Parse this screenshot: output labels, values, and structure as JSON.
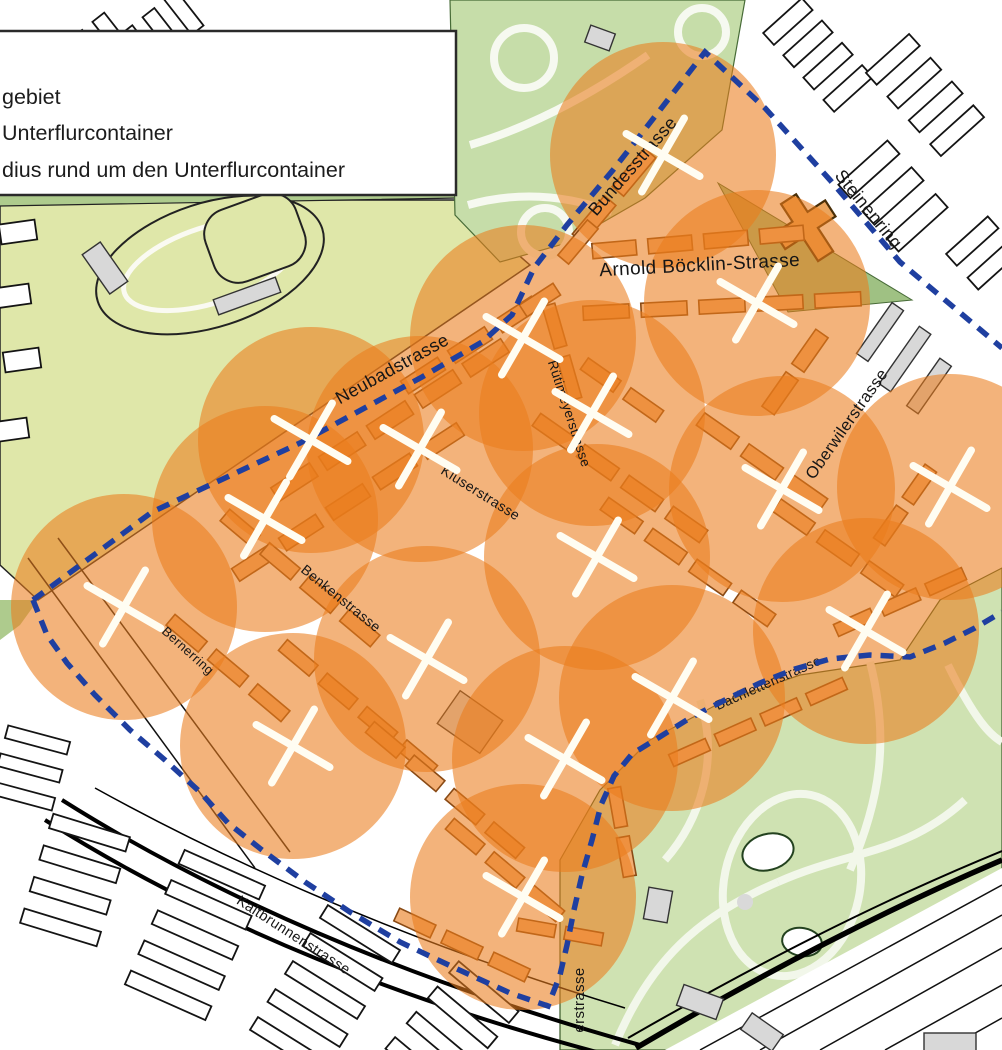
{
  "legend": {
    "items": [
      {
        "label": "gebiet"
      },
      {
        "label": "Unterflurcontainer"
      },
      {
        "label": "dius rund um den Unterflurcontainer"
      }
    ]
  },
  "map": {
    "colors": {
      "coverage_orange": "#ea7c1b",
      "boundary_blue": "#1f3fa0",
      "marker_white": "#fffdf2",
      "park_green": "#c6dda9",
      "zoo_green": "#cfe2b2",
      "sports_field": "#dfe7a9",
      "green_strip": "#aecb8d",
      "quarter_building": "#f2ae73",
      "quarter_outline": "#8a4a14"
    },
    "coverage_radius_px": 113,
    "streets": [
      {
        "name": "Bundesstrasse",
        "x": 637,
        "y": 170,
        "rot": -49,
        "size": 18
      },
      {
        "name": "Steinenring",
        "x": 864,
        "y": 213,
        "rot": 51,
        "size": 18
      },
      {
        "name": "Arnold Böcklin-Strasse",
        "x": 700,
        "y": 271,
        "rot": -3,
        "size": 19
      },
      {
        "name": "Neubadstrasse",
        "x": 395,
        "y": 374,
        "rot": -29,
        "size": 18
      },
      {
        "name": "Rütimeyerstrasse",
        "x": 565,
        "y": 415,
        "rot": 72,
        "size": 13.5
      },
      {
        "name": "Kluserstrasse",
        "x": 478,
        "y": 497,
        "rot": 32,
        "size": 14
      },
      {
        "name": "Oberwilerstrasse",
        "x": 851,
        "y": 427,
        "rot": -55,
        "size": 16.5
      },
      {
        "name": "Benkenstrasse",
        "x": 338,
        "y": 602,
        "rot": 39,
        "size": 14
      },
      {
        "name": "Bernerring",
        "x": 185,
        "y": 654,
        "rot": 42,
        "size": 13
      },
      {
        "name": "Bachlettenstrasse",
        "x": 770,
        "y": 687,
        "rot": -24,
        "size": 13.5
      },
      {
        "name": "Kaltbrunnenstrasse",
        "x": 291,
        "y": 939,
        "rot": 33,
        "size": 14.5
      },
      {
        "name": "erstrasse",
        "x": 584,
        "y": 1000,
        "rot": -90,
        "size": 15
      }
    ],
    "containers": [
      {
        "x": 663,
        "y": 155
      },
      {
        "x": 757,
        "y": 303
      },
      {
        "x": 523,
        "y": 338
      },
      {
        "x": 592,
        "y": 413
      },
      {
        "x": 311,
        "y": 440
      },
      {
        "x": 420,
        "y": 449
      },
      {
        "x": 265,
        "y": 519
      },
      {
        "x": 782,
        "y": 489
      },
      {
        "x": 950,
        "y": 487
      },
      {
        "x": 597,
        "y": 557
      },
      {
        "x": 124,
        "y": 607
      },
      {
        "x": 866,
        "y": 631
      },
      {
        "x": 427,
        "y": 659
      },
      {
        "x": 293,
        "y": 746
      },
      {
        "x": 672,
        "y": 698
      },
      {
        "x": 565,
        "y": 759
      },
      {
        "x": 523,
        "y": 897
      }
    ]
  }
}
